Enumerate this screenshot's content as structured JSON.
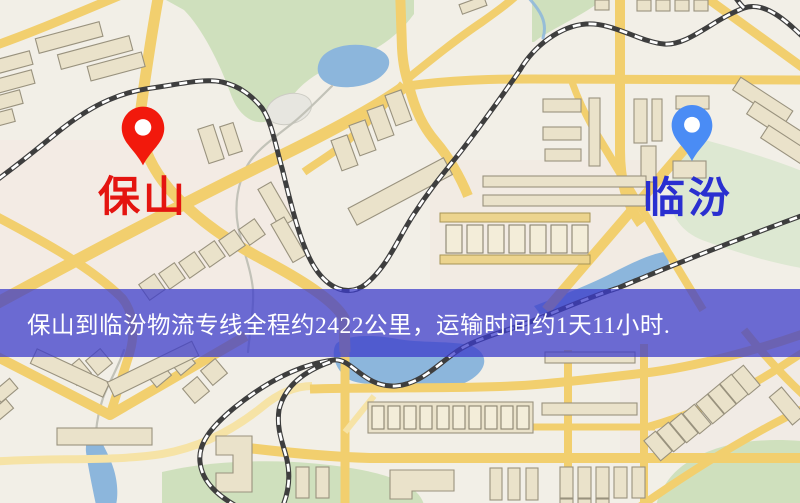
{
  "map": {
    "origin_label": "保山",
    "destination_label": "临汾"
  },
  "banner": {
    "text": "保山到临汾物流专线全程约2422公里，运输时间约1天11小时."
  },
  "route": {
    "origin": "保山",
    "destination": "临汾",
    "distance_text": "约2422公里",
    "duration_text": "约1天11小时"
  },
  "icons": {
    "origin_pin": "map-pin-icon",
    "destination_pin": "map-pin-icon"
  },
  "colors": {
    "bg": "#f2efe7",
    "road": "#f2cf6e",
    "road_light": "#f6e3a6",
    "green": "#cfe0bd",
    "green_soft": "#dde8d2",
    "water": "#8cb6dc",
    "building": "#eae2ca",
    "building_stroke": "#99927e",
    "rail_dark": "#3e3e3e",
    "stream": "#c2c2b8",
    "banner_bg": "rgba(60,60,202,0.74)",
    "banner_text": "#ffffff",
    "pin_origin": "#f2190c",
    "pin_destination": "#4a8cf5",
    "label_origin": "#e41410",
    "label_destination": "#2a2fd0"
  }
}
